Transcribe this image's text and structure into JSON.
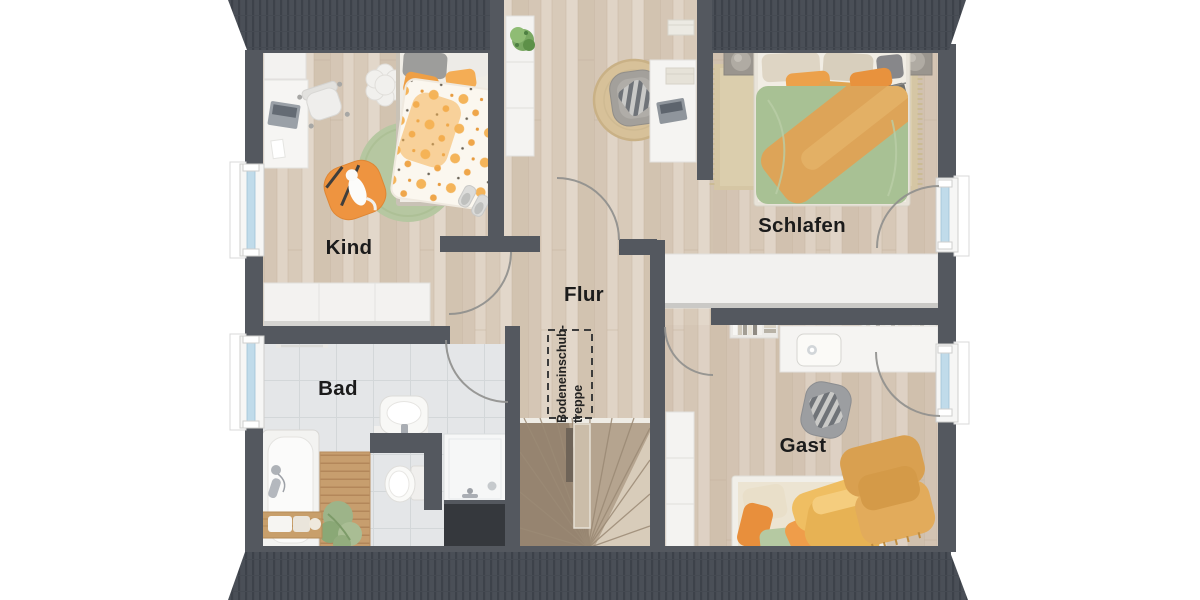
{
  "floorplan": {
    "type": "attic-floor-plan",
    "rooms": [
      {
        "id": "kind",
        "label": "Kind"
      },
      {
        "id": "schlafen",
        "label": "Schlafen"
      },
      {
        "id": "flur",
        "label": "Flur"
      },
      {
        "id": "bad",
        "label": "Bad"
      },
      {
        "id": "gast",
        "label": "Gast"
      }
    ],
    "annotations": [
      {
        "id": "attic-hatch",
        "line1": "Bodeneinschub-",
        "line2": "treppe"
      }
    ],
    "colors": {
      "wall": "#54585f",
      "roof": "#4a4f57",
      "wood_floor": "#dbcec0",
      "tile_floor": "#e4e6e8",
      "stair_wood": "#b5a48f",
      "window_glass": "#c0dbea",
      "white_furniture": "#f3f2f0",
      "accent_orange": "#e8923d",
      "accent_green": "#a8c194",
      "accent_yellow": "#e7b254",
      "rug_green": "#b6c7a1",
      "rug_jute": "#d7c199",
      "label_text": "#1b1b1b"
    }
  }
}
